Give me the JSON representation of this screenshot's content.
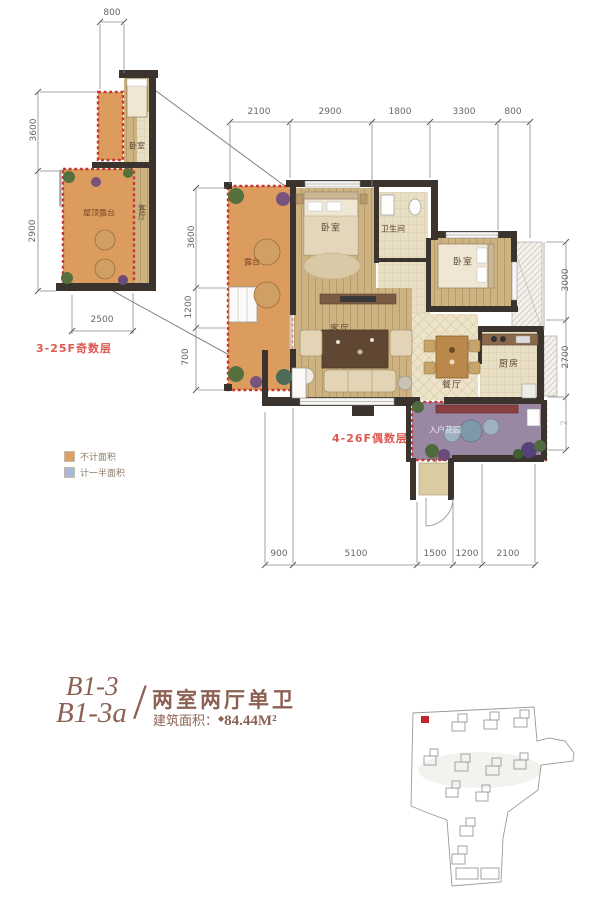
{
  "colors": {
    "wall": "#3a332e",
    "terrace_orange": "#dc9c5e",
    "entry_garden_purple": "#9a87a3",
    "red_dashed_border": "#c63832",
    "floor_label_red": "#dd5a52",
    "title_brown": "#8c6153",
    "site_marker_red": "#c4252b"
  },
  "icons": {
    "area_marker": "◆"
  },
  "legend": {
    "not_counted": {
      "label": "不计面积",
      "swatch_color": "#dd9f63"
    },
    "half_counted": {
      "label": "计一半面积",
      "swatch_color": "#a9b7d6"
    }
  },
  "floor_labels": {
    "odd": "3-25F奇数层",
    "even": "4-26F偶数层"
  },
  "small_plan": {
    "rooms": {
      "bedroom": "卧室",
      "living": "客厅",
      "terrace": "屋顶露台"
    },
    "dims": {
      "top": "800",
      "left_upper": "3600",
      "left_lower": "2900",
      "bottom": "2500"
    }
  },
  "main_plan": {
    "rooms": {
      "bedroom1": "卧室",
      "bathroom": "卫生间",
      "bedroom2": "卧室",
      "living": "客厅",
      "dining": "餐厅",
      "kitchen": "厨房",
      "entry_garden": "入户花园",
      "entry": "入户",
      "terrace": "露台"
    },
    "dims": {
      "top": [
        "2100",
        "2900",
        "1800",
        "3300",
        "800"
      ],
      "left": [
        "3600",
        "1200",
        "700"
      ],
      "right": [
        "3000",
        "2700",
        "2"
      ],
      "bottom": [
        "900",
        "5100",
        "1500",
        "1200",
        "2100"
      ]
    }
  },
  "title_block": {
    "unit_code_1": "B1-3",
    "unit_code_2": "B1-3a",
    "divider": "/",
    "layout_type": "两室两厅单卫",
    "area_label": "建筑面积：",
    "area_value": "84.44M²"
  }
}
